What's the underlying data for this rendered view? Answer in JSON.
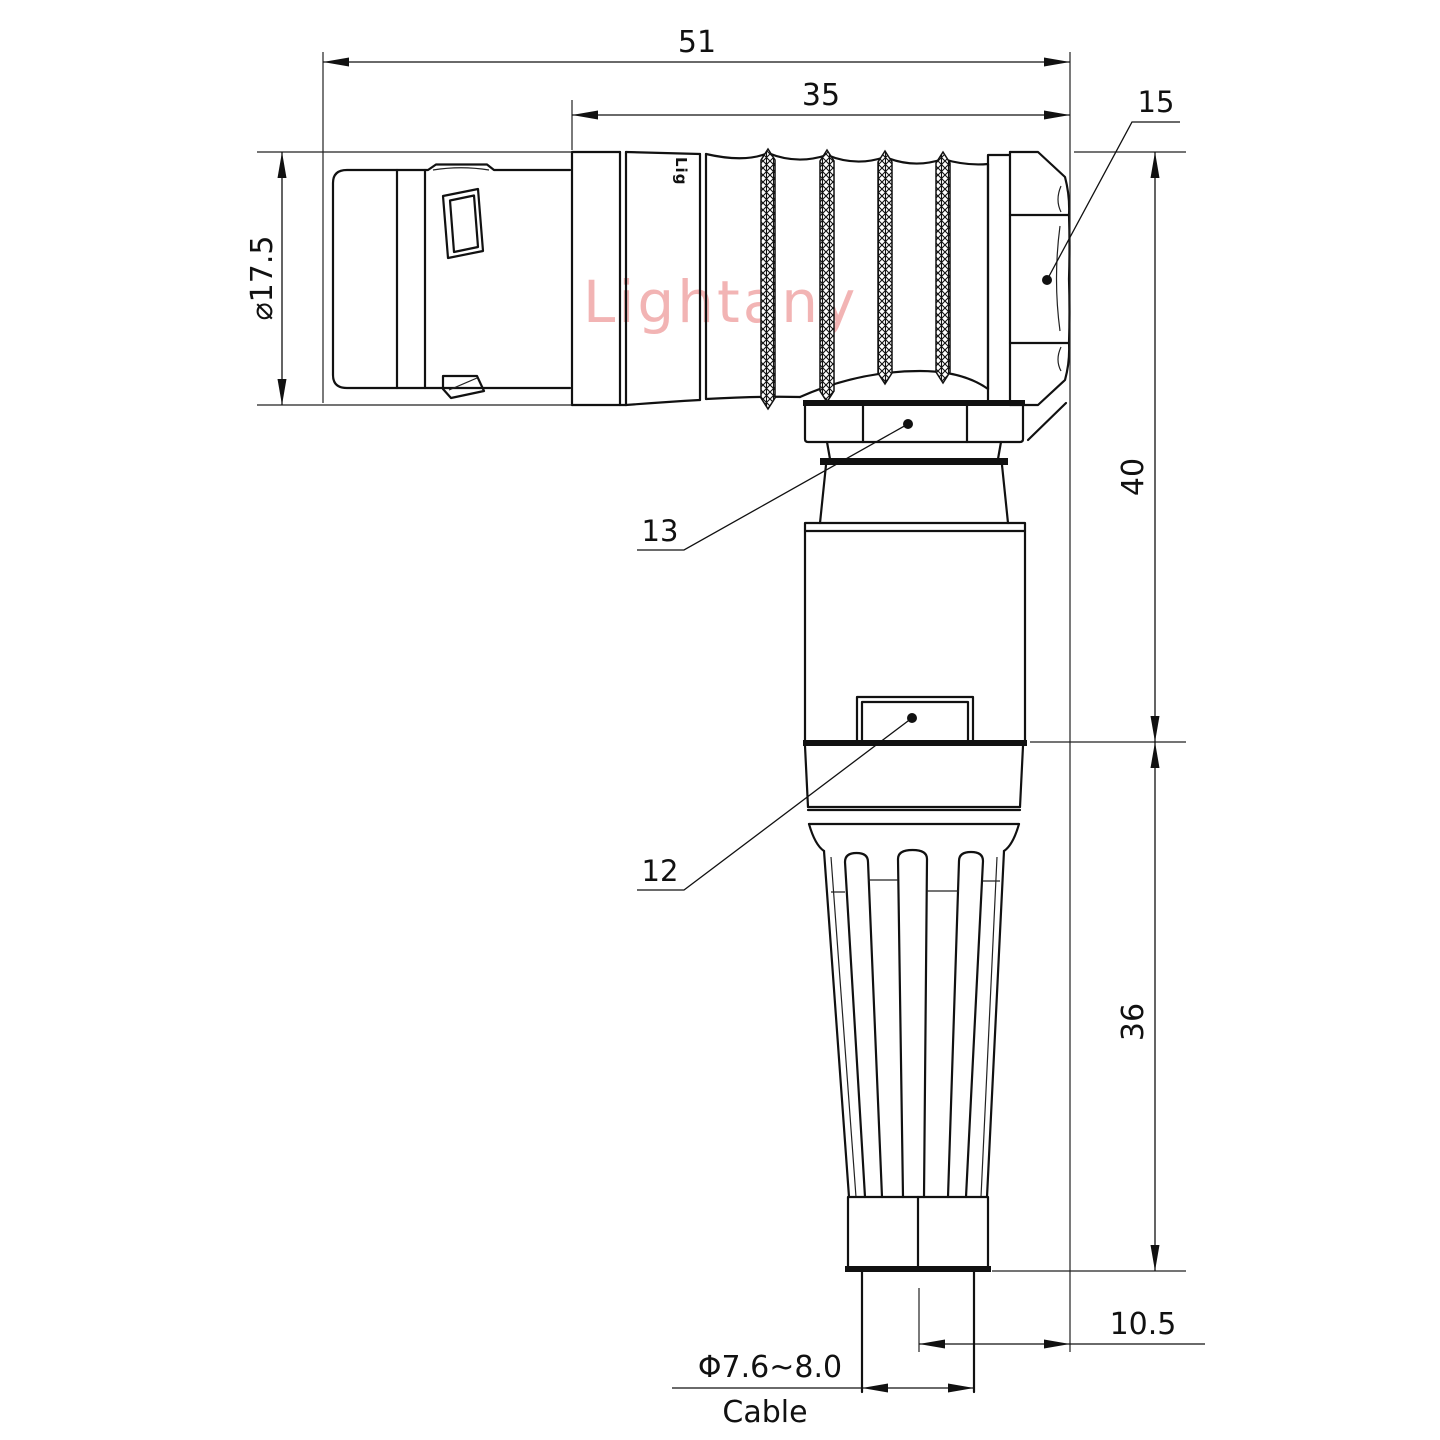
{
  "drawing": {
    "watermark": "Lightany",
    "body_marking": "Lig",
    "dims": {
      "overall_length": "51",
      "body_length": "35",
      "label_nut": "15",
      "front_diameter": "⌀17.5",
      "elbow_height": "40",
      "boot_length": "36",
      "axis_offset": "10.5",
      "cable_diameter": "Φ7.6~8.0",
      "cable_word": "Cable",
      "label_gland": "13",
      "label_sleeve": "12"
    },
    "colors": {
      "line": "#111111",
      "watermark": "#f2b4b4",
      "background": "#ffffff"
    }
  }
}
